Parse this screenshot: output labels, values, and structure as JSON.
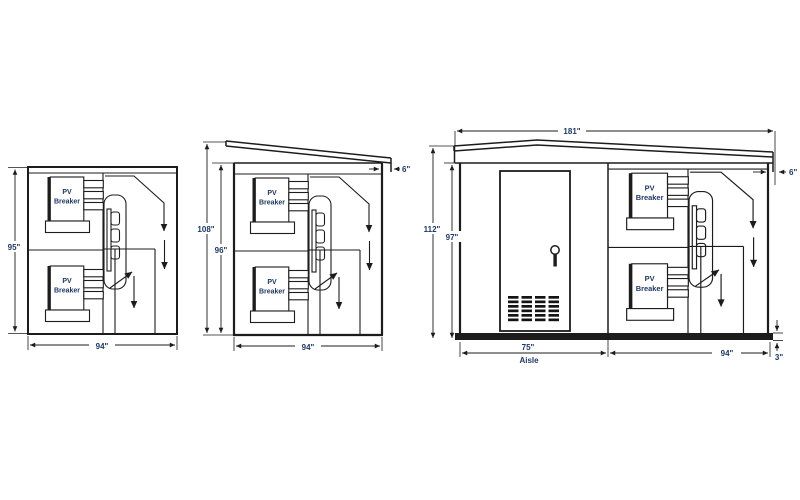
{
  "page": {
    "background": "#ffffff"
  },
  "diagram": {
    "line_color": "#1c1c1c",
    "text_color": "#1f3864",
    "breaker_label": {
      "line1": "PV",
      "line2": "Breaker"
    },
    "views": {
      "left": {
        "dims": {
          "height": "95\"",
          "width": "94\""
        }
      },
      "middle": {
        "dims": {
          "overall_height": "108\"",
          "wall_height": "96\"",
          "width": "94\"",
          "roof_overhang": "6\""
        }
      },
      "right": {
        "dims": {
          "overall_width": "181\"",
          "overall_height": "112\"",
          "wall_height": "97\"",
          "aisle_width": "75\"",
          "aisle_caption": "Aisle",
          "equipment_width": "94\"",
          "base_height": "3\"",
          "roof_overhang": "6\""
        }
      }
    }
  }
}
